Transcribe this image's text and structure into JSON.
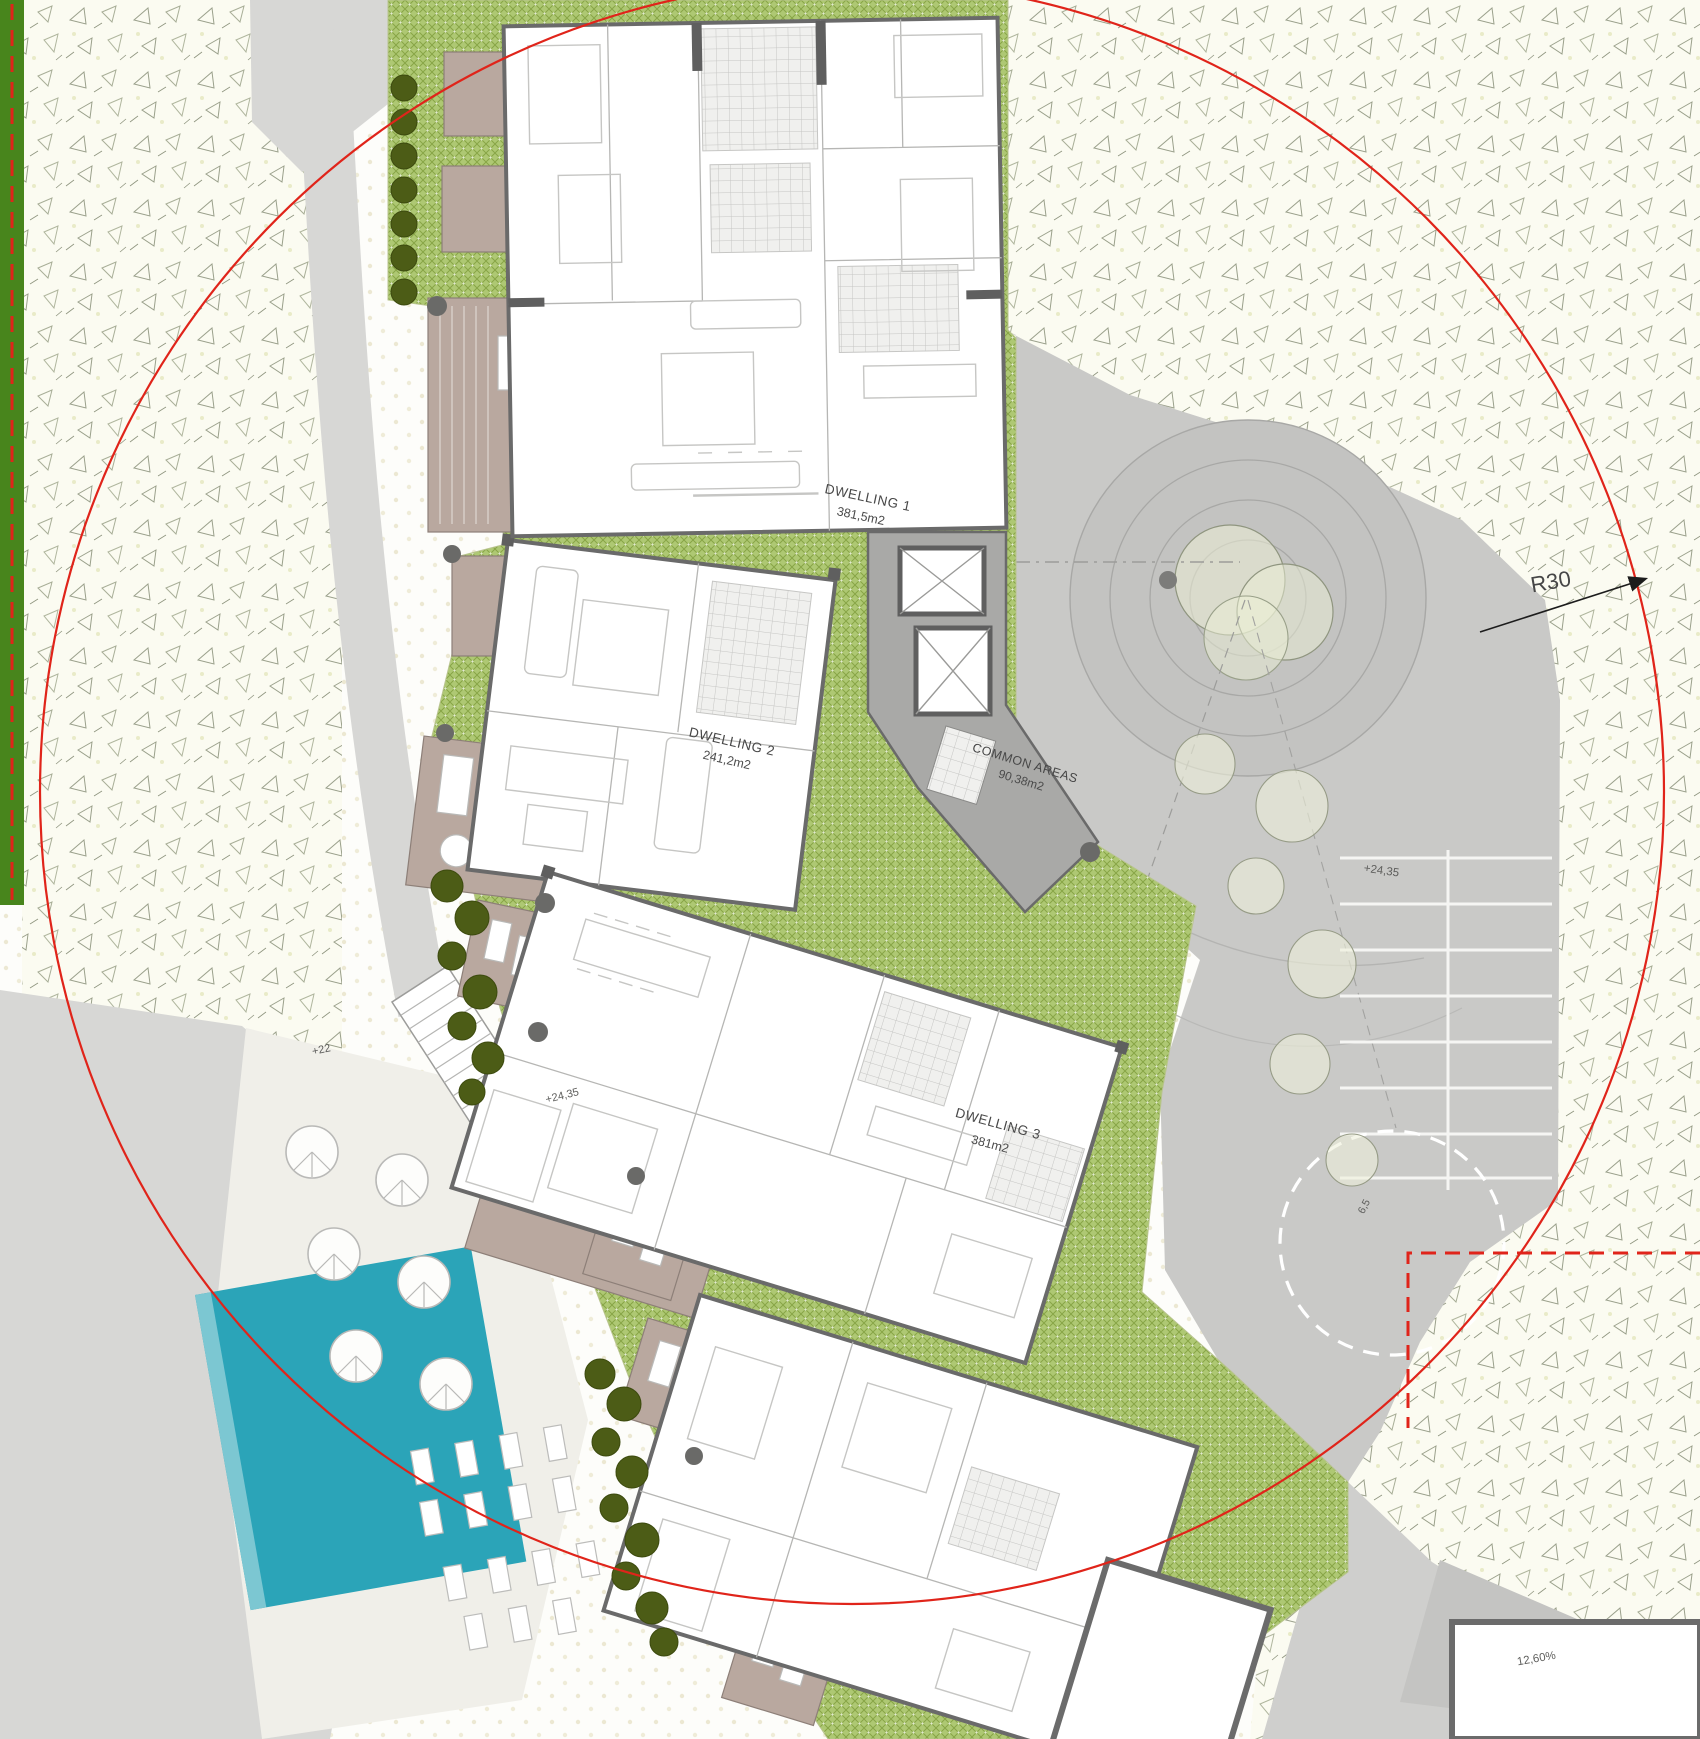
{
  "title": "Residential complex ground floor site plan",
  "labels": {
    "dwelling1_name": "DWELLING 1",
    "dwelling1_area": "381,5m2",
    "dwelling2_name": "DWELLING 2",
    "dwelling2_area": "241,2m2",
    "dwelling3_name": "DWELLING 3",
    "dwelling3_area": "381m2",
    "common_name": "COMMON AREAS",
    "common_area": "90,38m2",
    "radius": "R30",
    "level_plaza": "+24,35",
    "level_walkway": "+24,35",
    "level_road": "+22",
    "lane_width": "6,5",
    "ramp_slope": "12,60%"
  },
  "colors": {
    "site_circle_red": "#e0241a",
    "boundary_red": "#e0241a",
    "pool_teal": "#2ba4b8",
    "green_strip": "#48851c",
    "lawn_green": "#aec873",
    "lawn_hatch": "#87a546",
    "terrace_taupe": "#b9a89f",
    "wall_gray": "#6a6a6a",
    "common_gray": "#a9a9a7",
    "plaza_gray": "#c9c9c7",
    "road_gray": "#d7d7d5",
    "tree_dark_green": "#4c5c16",
    "turning_circle_white": "#ffffff"
  }
}
